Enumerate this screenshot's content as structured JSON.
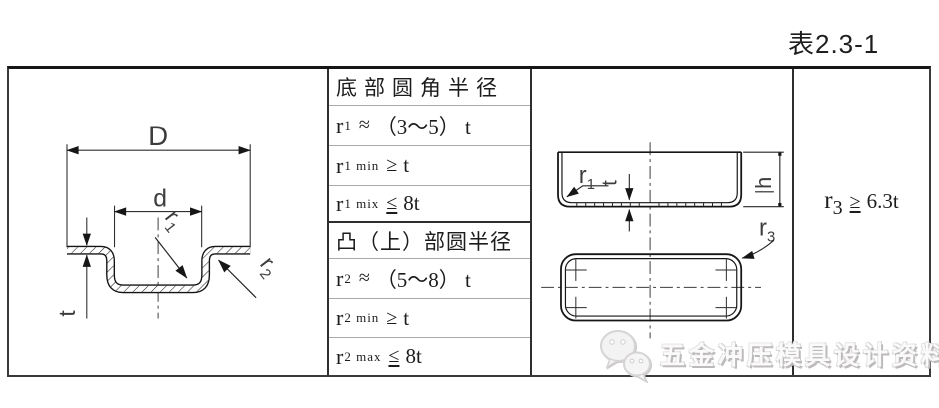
{
  "page": {
    "title": "表2.3-1"
  },
  "table": {
    "col2": {
      "rows": [
        {
          "text": "底部圆角半径"
        },
        {
          "base": "r",
          "sub": "1",
          "op": "≈",
          "rhs": "（3～5） t"
        },
        {
          "base": "r",
          "sub": "1 min",
          "op": "≥",
          "rhs": "t"
        },
        {
          "base": "r",
          "sub": "1 mix",
          "op": "≤",
          "rhs": "8t"
        },
        {
          "text": "凸（上）部圆半径"
        },
        {
          "base": "r",
          "sub": "2",
          "op": "≈",
          "rhs": "（5～8） t"
        },
        {
          "base": "r",
          "sub": "2 min",
          "op": "≥",
          "rhs": "t"
        },
        {
          "base": "r",
          "sub": "2 max",
          "op": "≤",
          "rhs": "8t"
        }
      ]
    },
    "col4": {
      "base": "r",
      "sub": "3",
      "op": "≥",
      "rhs": "6.3t"
    },
    "drawing_section": {
      "labels": {
        "D": "D",
        "d": "d",
        "t": "t",
        "r1_base": "r",
        "r1_sub": "1",
        "r2_base": "r",
        "r2_sub": "2"
      }
    },
    "drawing_views": {
      "labels": {
        "r1_base": "r",
        "r1_sub": "1",
        "t": "t",
        "h": "h",
        "r3_base": "r",
        "r3_sub": "3"
      }
    }
  },
  "watermark": {
    "icon": "wechat-icon",
    "text": "五金冲压模具设计资料"
  },
  "colors": {
    "line": "#2e2e2e",
    "row_divider": "#a9a9a9",
    "watermark_text": "#fbfafa"
  }
}
